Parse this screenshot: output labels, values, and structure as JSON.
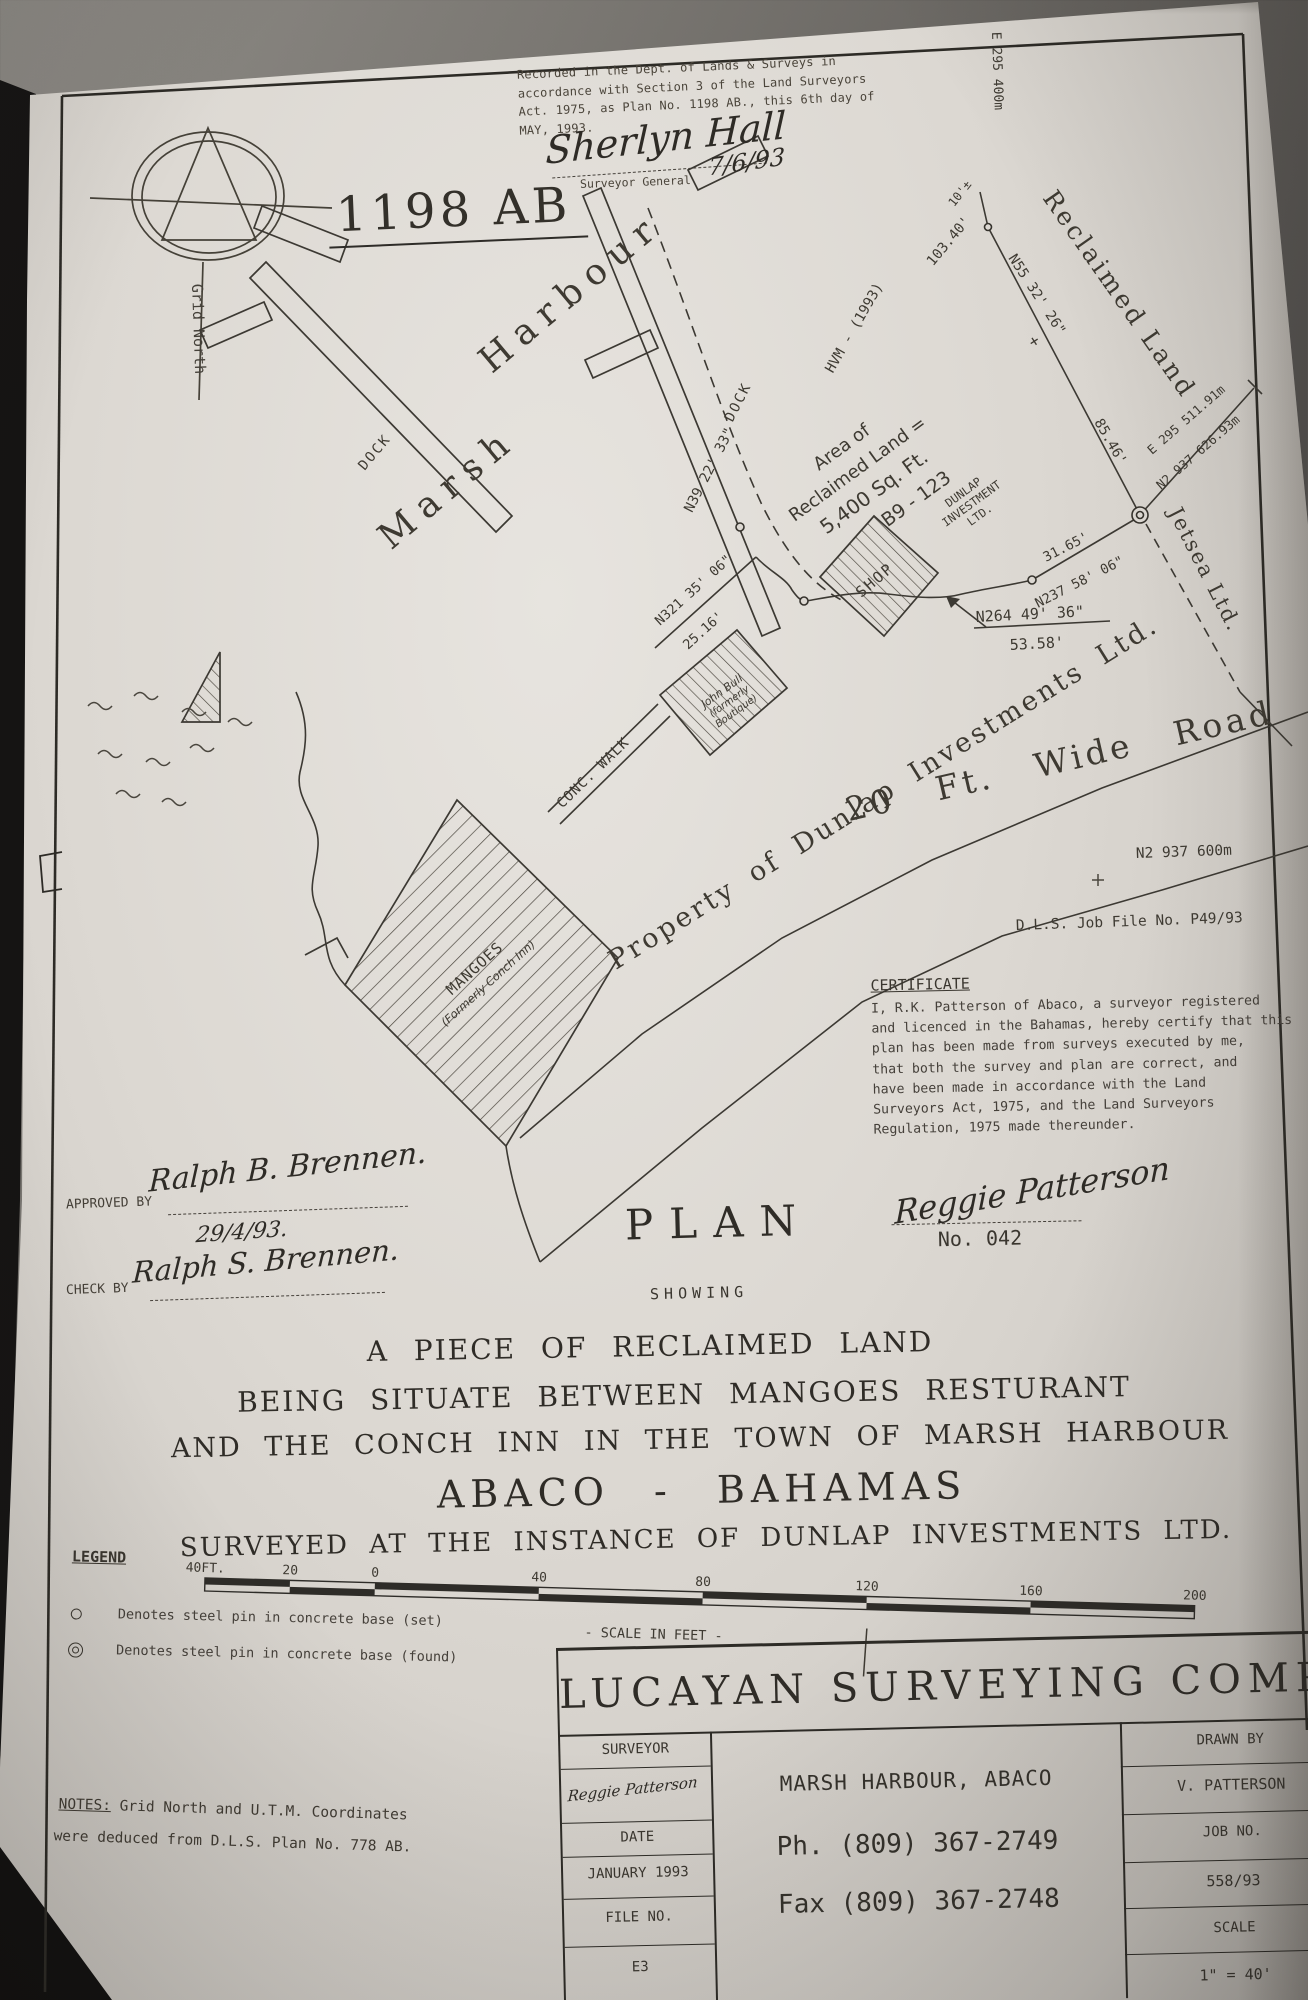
{
  "stamp": {
    "line1": "Recorded in the Dept. of Lands & Surveys in",
    "line2": "accordance with Section 3 of the Land Surveyors",
    "line3": "Act. 1975, as Plan No. 1198 AB., this 6th day of",
    "line4": "MAY, 1993.",
    "signature": "Sherlyn Hall",
    "signer_title": "Surveyor General",
    "sign_date": "7/6/93"
  },
  "plan_number": "1198 AB",
  "compass": {
    "label": "Grid North"
  },
  "map": {
    "marsh": "Marsh",
    "harbour": "Harbour",
    "dock_a": "DOCK",
    "dock_b": "DOCK",
    "hwm": "HVM - (1993)",
    "bearing_n39": "N39 22' 33\"",
    "len_103": "103.40'",
    "len_10": "10'±",
    "bearing_n55": "N55 32' 26\"",
    "plus": "+",
    "len_85": "85.46'",
    "reclaimed": "Reclaimed Land",
    "grid_e_top": "E 295 400m",
    "coord_e": "E 295 511.91m",
    "coord_n": "N2 937 626.93m",
    "jetsea": "Jetsea Ltd.",
    "len_31": "31.65'",
    "bearing_n237": "N237 58' 06\"",
    "bearing_n264": "N264 49' 36\"",
    "len_53": "53.58'",
    "bearing_n321": "N321 35' 06\"",
    "len_25": "25.16'",
    "area_line1": "Area of",
    "area_line2": "Reclaimed Land =",
    "area_line3": "5,400 Sq. Ft.",
    "parcel": "B9 - 123",
    "owner_line1": "DUNLAP",
    "owner_line2": "INVESTMENT",
    "owner_line3": "LTD.",
    "shop": "SHOP",
    "boutique_line1": "John Bull",
    "boutique_line2": "(formerly",
    "boutique_line3": "Boutique)",
    "conc_walk": "CONC. WALK",
    "mangoes_line1": "MANGOES",
    "mangoes_line2": "(Formerly Conch Inn)",
    "property": "Property of Dunlap Investments Ltd.",
    "road": "20 Ft. Wide Road",
    "grid_n_right": "N2 937 600m",
    "job_file": "D.L.S. Job File No. P49/93"
  },
  "certificate": {
    "title": "CERTIFICATE",
    "lines": [
      "I, R.K. Patterson of Abaco, a surveyor registered",
      "and licenced in the Bahamas, hereby certify that this",
      "plan has been made from surveys executed by me,",
      "that both the survey and plan are correct, and",
      "have been made in accordance with the Land",
      "Surveyors Act, 1975, and the Land Surveyors",
      "Regulation, 1975 made thereunder."
    ],
    "signature": "Reggie Patterson",
    "number": "No. 042"
  },
  "approvals": {
    "approved_label": "APPROVED BY",
    "approved_signature": "Ralph B. Brennen.",
    "approved_date": "29/4/93.",
    "check_label": "CHECK BY",
    "check_signature": "Ralph S. Brennen."
  },
  "heading": {
    "plan": "PLAN",
    "showing": "SHOWING",
    "title1": "A PIECE OF RECLAIMED LAND",
    "title2": "BEING SITUATE BETWEEN MANGOES RESTURANT",
    "title3": "AND THE CONCH INN IN THE TOWN OF MARSH HARBOUR",
    "title4": "ABACO - BAHAMAS",
    "title5": "SURVEYED AT THE INSTANCE OF DUNLAP INVESTMENTS LTD."
  },
  "scalebar": {
    "ticks": [
      "40FT.",
      "20",
      "0",
      "40",
      "80",
      "120",
      "160",
      "200"
    ],
    "caption": "- SCALE IN FEET -"
  },
  "legend": {
    "title": "LEGEND",
    "item1": "Denotes steel pin in concrete base (set)",
    "item2": "Denotes steel pin in concrete base (found)"
  },
  "notes": {
    "label": "NOTES:",
    "line1": "Grid North and U.T.M. Coordinates",
    "line2": "were deduced from D.L.S. Plan No. 778 AB."
  },
  "title_block": {
    "company": "LUCAYAN SURVEYING COMPANY",
    "surveyor_label": "SURVEYOR",
    "surveyor_signature": "Reggie Patterson",
    "date_label": "DATE",
    "date_value": "JANUARY 1993",
    "file_label": "FILE NO.",
    "file_value": "E3",
    "address": "MARSH HARBOUR, ABACO",
    "phone": "Ph. (809) 367-2749",
    "fax": "Fax (809) 367-2748",
    "drawn_label": "DRAWN BY",
    "drawn_value": "V. PATTERSON",
    "job_label": "JOB NO.",
    "job_value": "558/93",
    "scale_label": "SCALE",
    "scale_value": "1\" = 40'"
  }
}
